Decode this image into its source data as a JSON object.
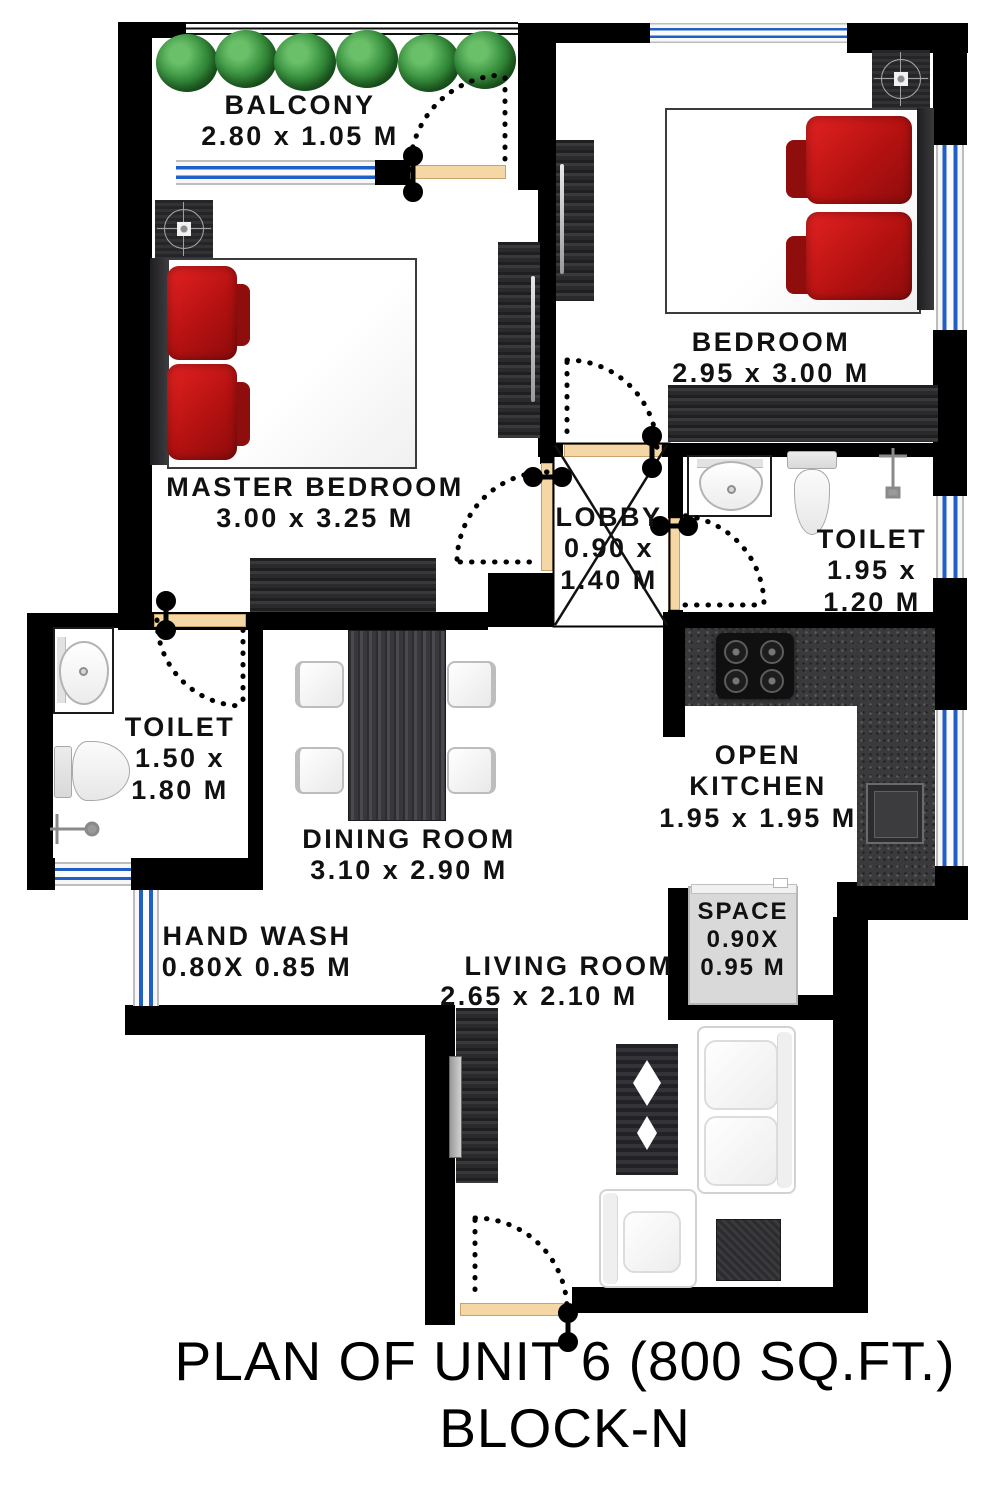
{
  "title": {
    "line1": "PLAN OF UNIT 6 (800 SQ.FT.)",
    "line2": "BLOCK-N"
  },
  "rooms": {
    "balcony": {
      "name": "BALCONY",
      "dims": "2.80 x 1.05 M"
    },
    "master_bedroom": {
      "name": "MASTER BEDROOM",
      "dims": "3.00 x 3.25 M"
    },
    "bedroom": {
      "name": "BEDROOM",
      "dims": "2.95 x 3.00 M"
    },
    "lobby": {
      "name": "LOBBY",
      "dim_line1": "0.90 x",
      "dim_line2": "1.40 M"
    },
    "toilet_right": {
      "name": "TOILET",
      "dim_line1": "1.95 x",
      "dim_line2": "1.20 M"
    },
    "toilet_left": {
      "name": "TOILET",
      "dim_line1": "1.50 x",
      "dim_line2": "1.80 M"
    },
    "dining_room": {
      "name": "DINING ROOM",
      "dims": "3.10 x 2.90 M"
    },
    "open_kitchen": {
      "name_line1": "OPEN",
      "name_line2": "KITCHEN",
      "dims": "1.95 x 1.95 M"
    },
    "space": {
      "name": "SPACE",
      "dim_line1": "0.90X",
      "dim_line2": "0.95 M"
    },
    "hand_wash": {
      "name": "HAND WASH",
      "dims": "0.80X 0.85 M"
    },
    "living_room": {
      "name": "LIVING ROOM",
      "dims": "2.65 x 2.10 M"
    }
  },
  "colors": {
    "wall": "#000000",
    "window_blue": "#2060c6",
    "door_wood": "#f2d3a0",
    "pillow_red": "#c01313",
    "hedge_green": "#2e7d32"
  }
}
